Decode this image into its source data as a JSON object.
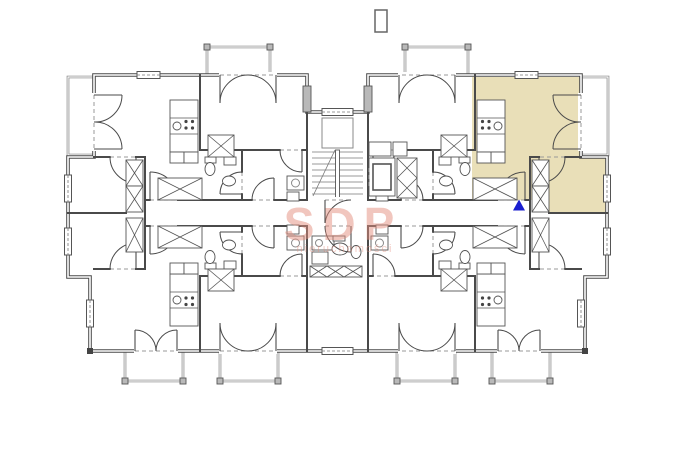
{
  "watermark": {
    "brand": "SDP",
    "subtitle": "nieruchomości"
  },
  "colors": {
    "background": "#ffffff",
    "walls": "#4a4a4a",
    "thin_lines": "#8a8a8a",
    "highlight": "#e9dfb8",
    "marker": "#1a1ecf",
    "watermark": "#e48f7f"
  },
  "plan": {
    "type": "apartment building floor plan",
    "highlighted_unit": "upper-right apartment with balcony and small room",
    "marker_shape": "blue triangle at unit entrance"
  }
}
